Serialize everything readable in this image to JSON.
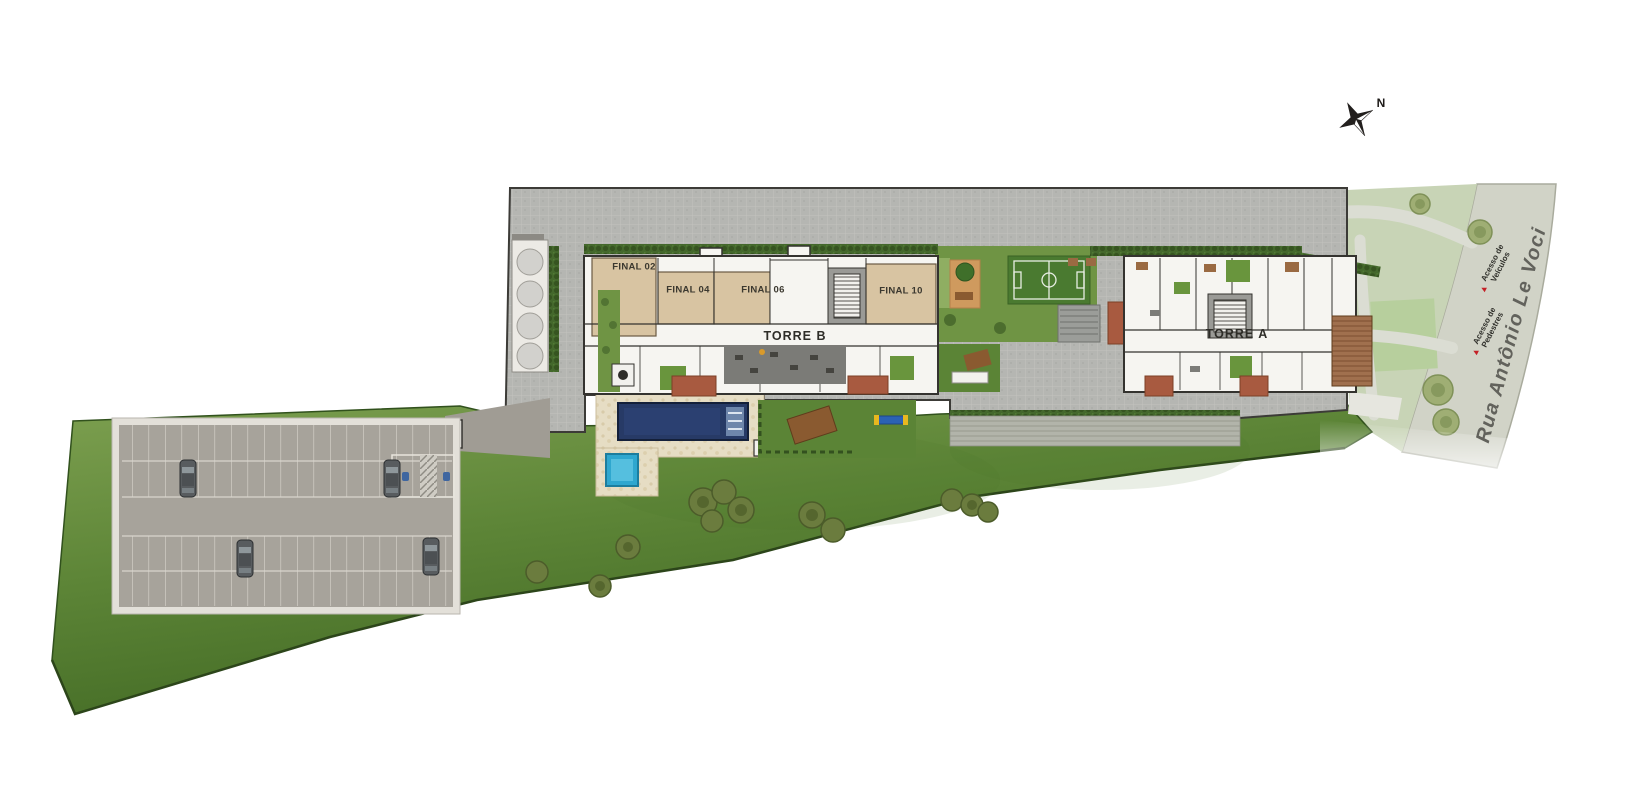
{
  "plan": {
    "north_label": "N",
    "towers": {
      "torre_b": "TORRE B",
      "torre_a": "TORRE A"
    },
    "units": {
      "final_02": "FINAL 02",
      "final_04": "FINAL 04",
      "final_06": "FINAL 06",
      "final_10": "FINAL 10"
    },
    "street": {
      "name": "Rua Antônio Le Voci"
    },
    "access": {
      "vehicles": {
        "marker": "▲",
        "line1": "Acesso de",
        "line2": "Veículos"
      },
      "pedestrians": {
        "marker": "▲",
        "line1": "Acesso de",
        "line2": "Pedestres"
      }
    }
  },
  "colors": {
    "lawn_light": "#7da050",
    "lawn_dark": "#3c6420",
    "paving": "#b5b6b2",
    "parking_asphalt": "#a7a39b",
    "pool_main": "#273a66",
    "pool_kids": "#2fa7cf",
    "deck": "#e6ddc4",
    "unit_tan": "#d8c4a2",
    "terracotta": "#a85a40",
    "court_green": "#4a7a30",
    "street": "#d1d3c7",
    "sidewalk_green": "#c8d4b6",
    "access_marker_red": "#c42127"
  }
}
